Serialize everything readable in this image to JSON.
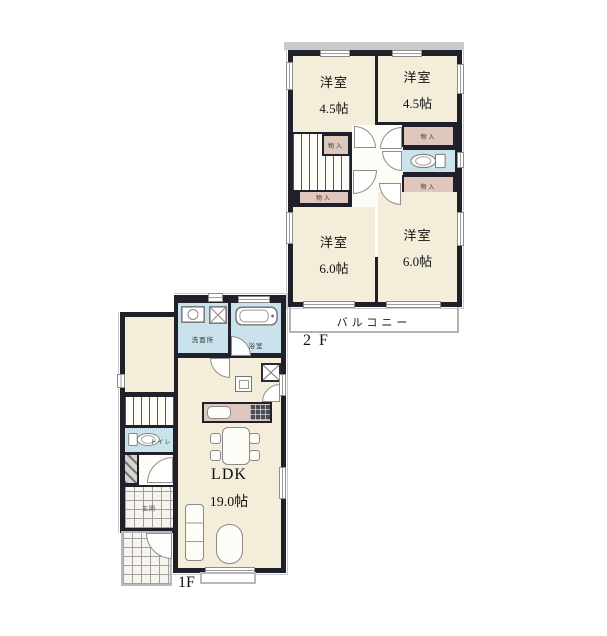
{
  "floor2": {
    "floor_label": "2 F",
    "balcony": "バルコニー",
    "rooms": [
      {
        "name": "洋室",
        "size": "4.5帖"
      },
      {
        "name": "洋室",
        "size": "4.5帖"
      },
      {
        "name": "洋室",
        "size": "6.0帖"
      },
      {
        "name": "洋室",
        "size": "6.0帖"
      }
    ],
    "closets": [
      "物入",
      "物入",
      "物入",
      "物入"
    ]
  },
  "floor1": {
    "floor_label": "1F",
    "ldk": {
      "name": "LDK",
      "size": "19.0帖"
    },
    "washroom": "洗面所",
    "bathroom": "浴室",
    "toilet": "トイレ",
    "entrance": "玄関"
  },
  "colors": {
    "wall": "#20202b",
    "room_floor": "#f3edda",
    "closet_pink": "#dfc7bd",
    "wet_area_blue": "#c9e2ec",
    "balcony_border": "#b3b3b3"
  }
}
